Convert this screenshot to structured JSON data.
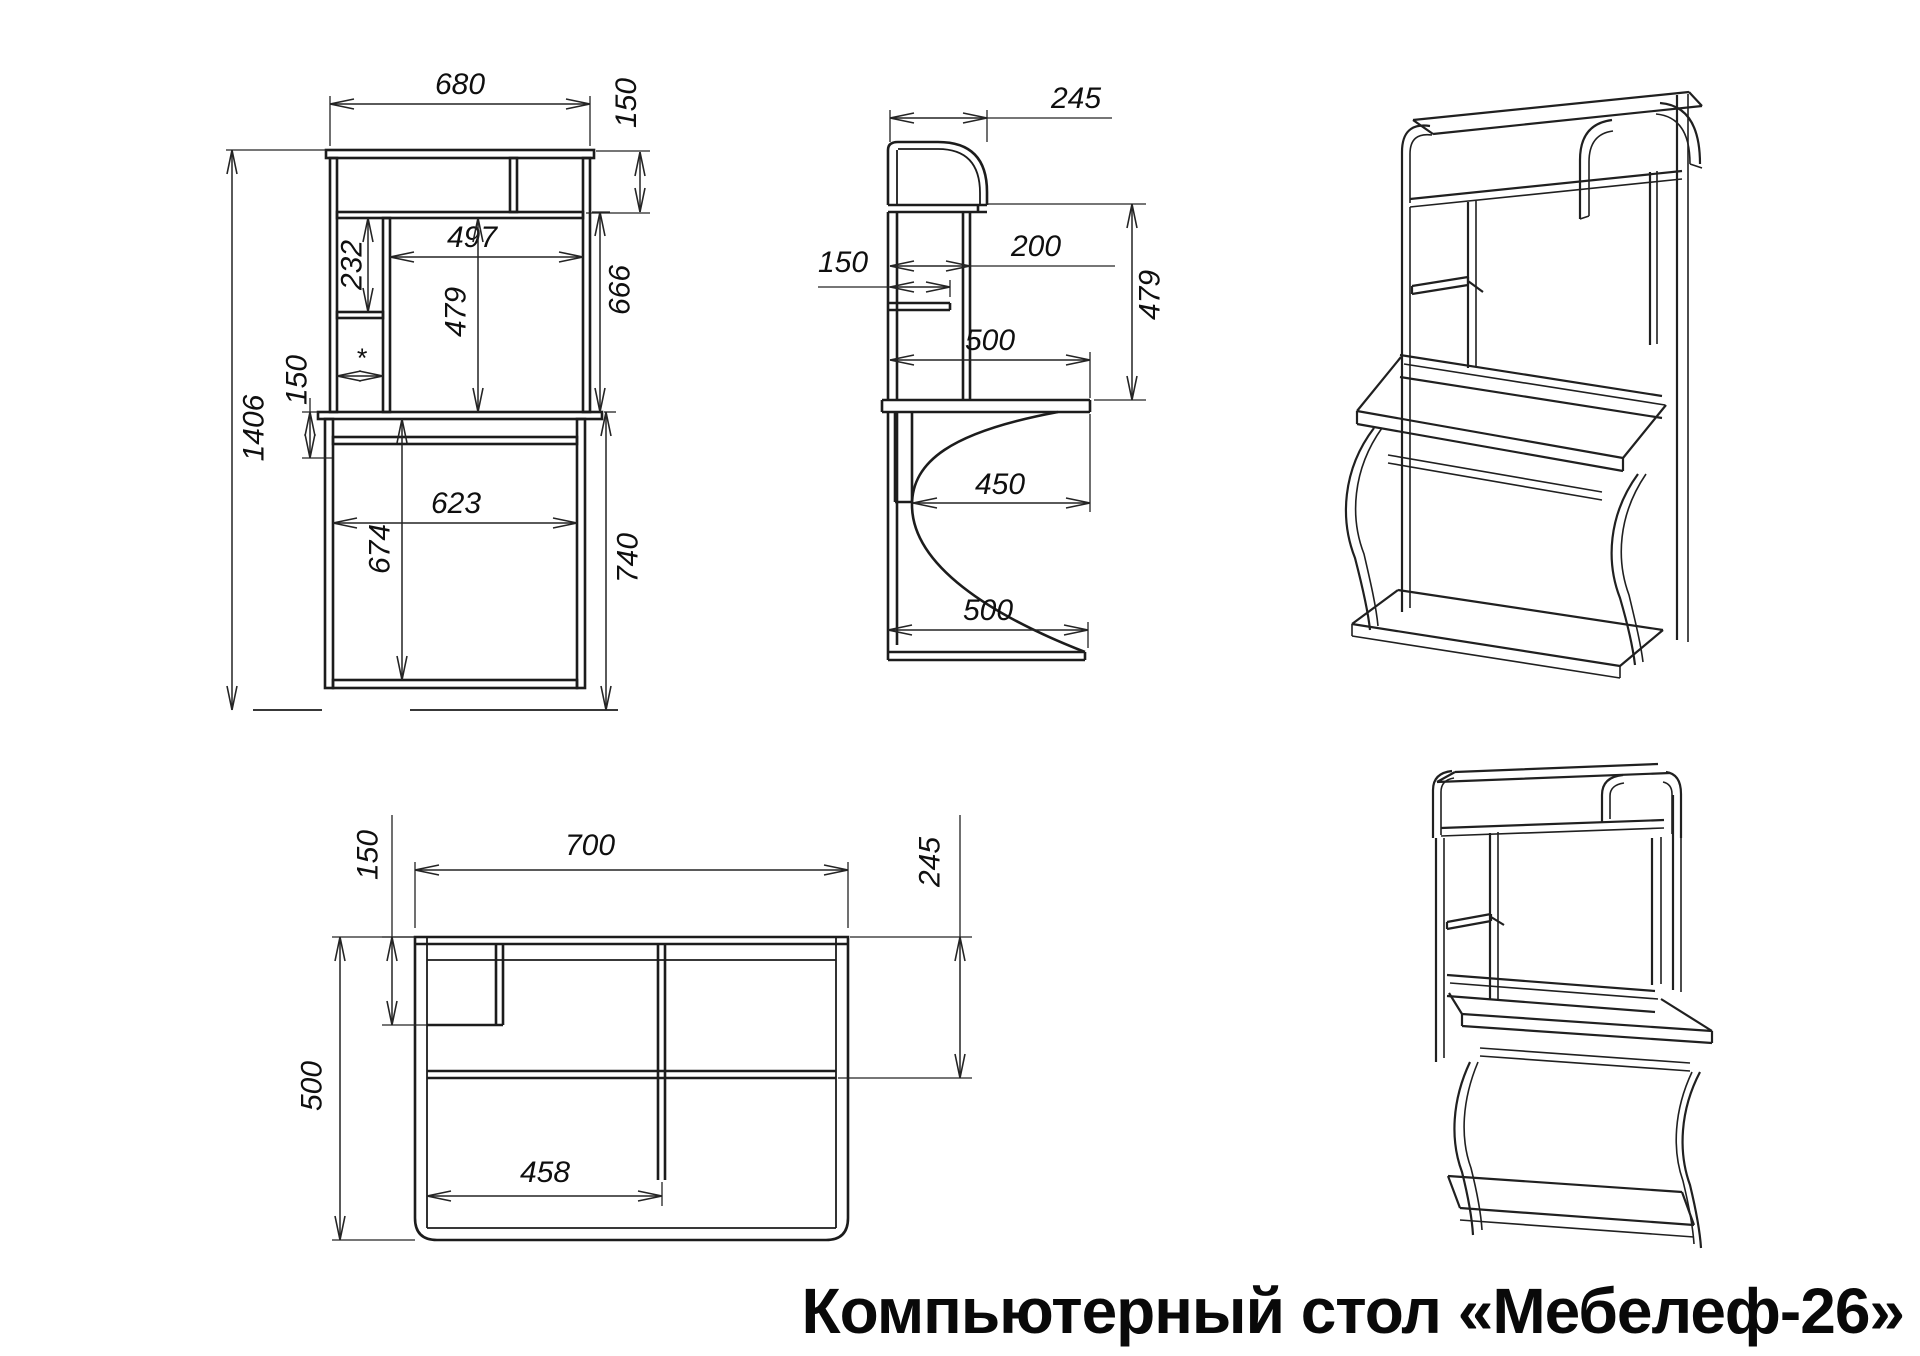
{
  "title": "Компьютерный стол «Мебелеф-26»",
  "line_color": "#1c1c1c",
  "views": {
    "front": {
      "dims": {
        "overall_width": "680",
        "cornice_height": "150",
        "niche_width": "497",
        "shelf_spacing": "232",
        "niche_height": "479",
        "hutch_height": "666",
        "apron_height": "150",
        "overall_height": "1406",
        "desk_inner_width": "623",
        "underdesk_height": "674",
        "desk_height": "740",
        "note_star": "*"
      }
    },
    "side": {
      "dims": {
        "hutch_depth": "245",
        "shelf_depth": "150",
        "divider_depth": "200",
        "niche_height": "479",
        "top_depth": "500",
        "desktop_depth": "450",
        "base_depth": "500"
      }
    },
    "top": {
      "dims": {
        "shelf_depth": "150",
        "overall_width": "700",
        "hutch_depth": "245",
        "overall_depth": "500",
        "inner_width": "458"
      }
    }
  }
}
